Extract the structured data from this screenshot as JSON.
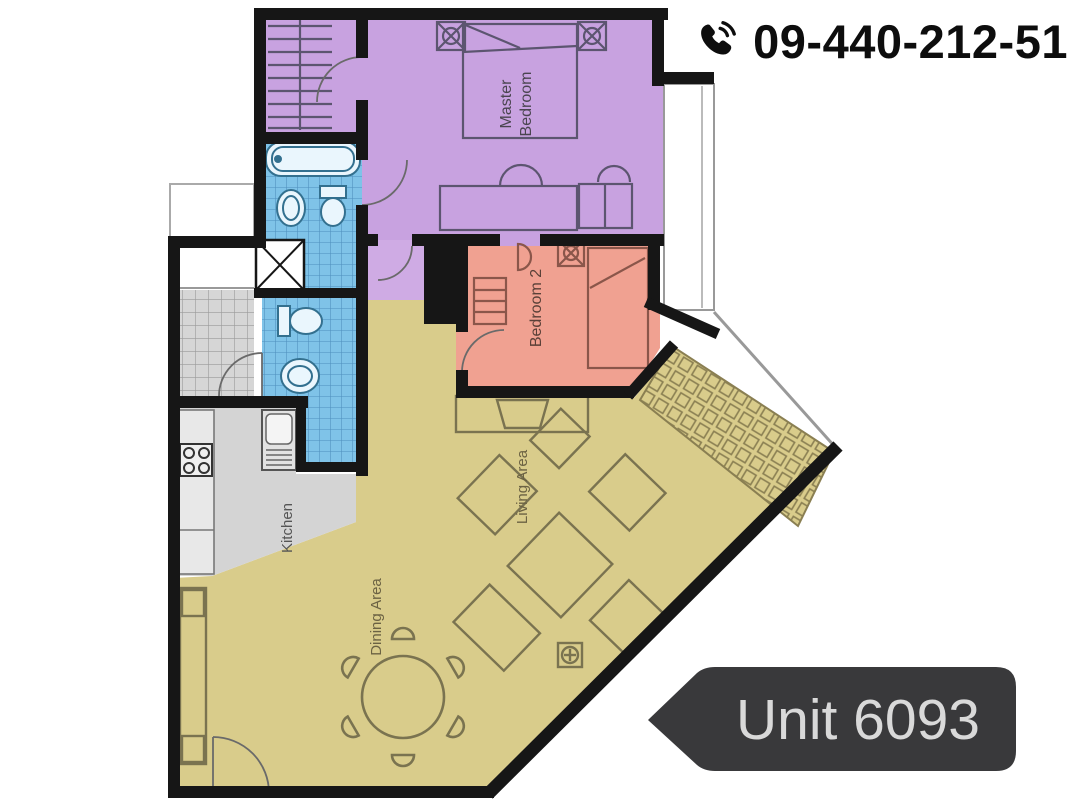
{
  "header": {
    "phone_number": "09-440-212-51"
  },
  "unit_tag": {
    "label": "Unit 6093"
  },
  "rooms": {
    "master_line1": "Master",
    "master_line2": "Bedroom",
    "bedroom2": "Bedroom 2",
    "living": "Living Area",
    "dining": "Dining Area",
    "kitchen": "Kitchen"
  },
  "colors": {
    "master_bedroom": "#c8a2e0",
    "closet": "#c8a2e0",
    "corridor": "#cfabe4",
    "bedroom2": "#f0a191",
    "living_dining": "#d9cc8b",
    "kitchen": "#d4d4d4",
    "bathroom": "#7fc3e8",
    "wall": "#161616",
    "tag_background": "#39393b",
    "tag_text": "#d9d9d9",
    "phone_text": "#0d0d0d"
  }
}
